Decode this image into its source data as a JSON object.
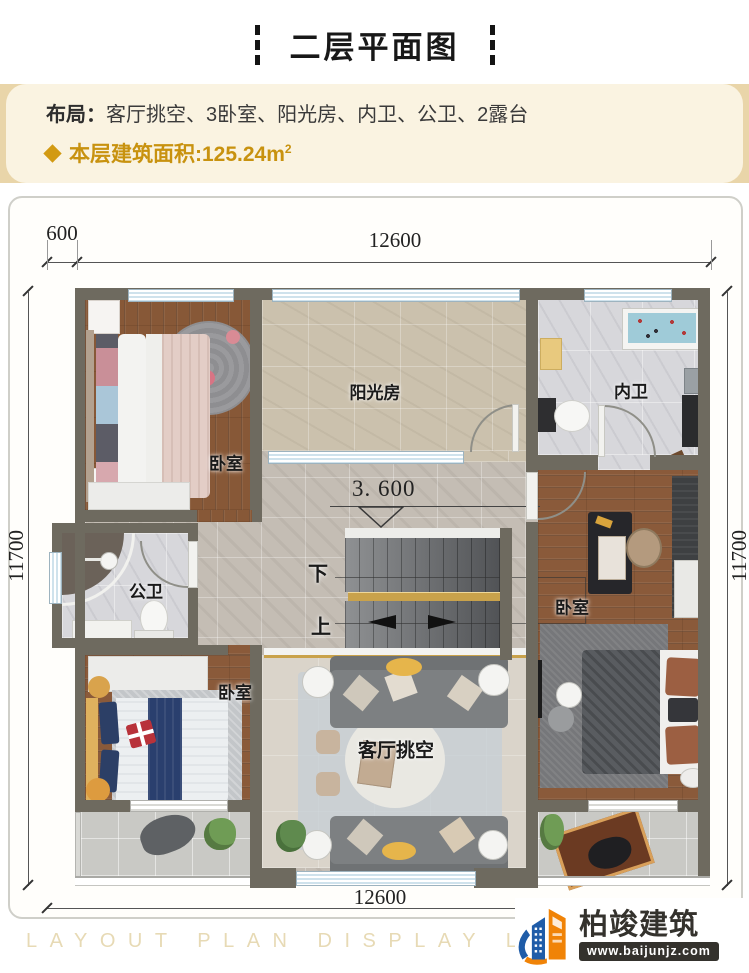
{
  "header": {
    "title": "二层平面图"
  },
  "info": {
    "layout_label": "布局：",
    "layout_value": "客厅挑空、3卧室、阳光房、内卫、公卫、2露台",
    "area_label": "本层建筑面积:",
    "area_value": "125.24m",
    "area_sup": "2"
  },
  "dimensions": {
    "top_offset": "600",
    "top_width": "12600",
    "left_height": "11700",
    "right_height": "11700",
    "bottom_width": "12600"
  },
  "rooms": {
    "bedroom_top_left": "卧室",
    "sunroom": "阳光房",
    "inner_bath": "内卫",
    "public_bath": "公卫",
    "bedroom_right": "卧室",
    "bedroom_bottom_left": "卧室",
    "living_void": "客厅挑空"
  },
  "stairs": {
    "elevation": "3. 600",
    "down_label": "下",
    "up_label": "上"
  },
  "footer": {
    "watermark": "LAYOUT PLAN DISPLAY LAYOUT PLAN DISPLAY LAYOUT",
    "brand_name": "柏竣建筑",
    "brand_url": "www.baijunjz.com"
  },
  "colors": {
    "accent_gold": "#c8920f",
    "wall": "#6e6a5f",
    "brand_blue": "#1f5ca8",
    "brand_orange": "#f08307"
  }
}
